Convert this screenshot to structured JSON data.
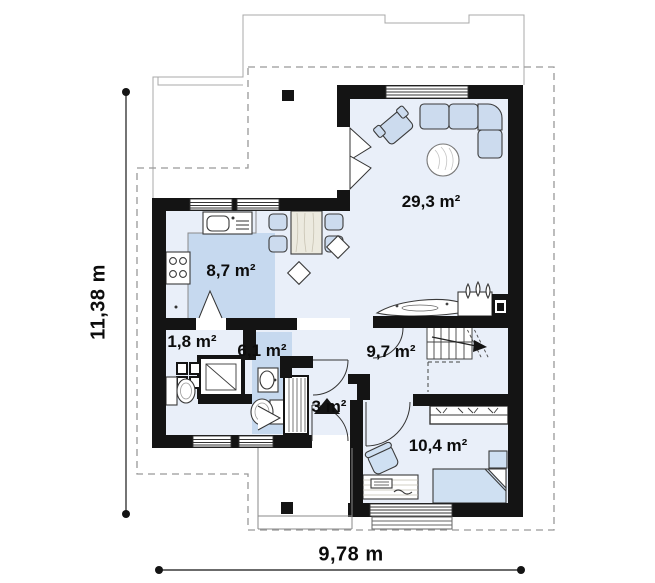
{
  "rooms": [
    {
      "id": "kitchen",
      "label": "8,7 m²"
    },
    {
      "id": "living-room",
      "label": "29,3 m²"
    },
    {
      "id": "wc",
      "label": "1,8 m²"
    },
    {
      "id": "bathroom",
      "label": "6,1 m²"
    },
    {
      "id": "hall",
      "label": "9,7 m²"
    },
    {
      "id": "entry",
      "label": "3 m²"
    },
    {
      "id": "bedroom",
      "label": "10,4 m²"
    }
  ],
  "dimensions": {
    "height_label": "11,38 m",
    "width_label": "9,78 m"
  },
  "colors": {
    "walls": "#141414",
    "floor_light": "#e9eff9",
    "floor_accent": "#c6d9ef",
    "furniture_fill": "#ccdbee",
    "dashed_outline": "#999999"
  }
}
